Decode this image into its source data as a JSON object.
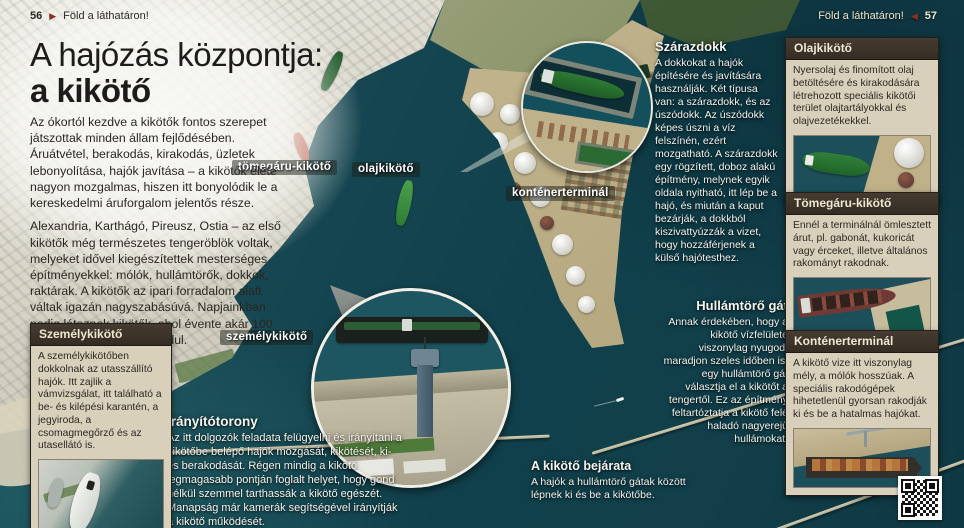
{
  "header_left": {
    "page_number": "56",
    "arrow": "▶",
    "title": "Föld a láthatáron!"
  },
  "header_right": {
    "title": "Föld a láthatáron!",
    "arrow": "◀",
    "page_number": "57"
  },
  "title": {
    "line1": "A hajózás központja:",
    "line2": "a kikötő"
  },
  "intro": {
    "p1": "Az ókortól kezdve a kikötők fontos szerepet játszottak minden állam fejlődésében. Áruátvétel, berakodás, kirakodás, üzletek lebonyolítása, hajók javítása – a kikötők élete nagyon mozgalmas, hiszen itt bonyolódik le a kereskedelmi áruforgalom jelentős része.",
    "p2": "Alexandria, Karthágó, Pireusz, Ostia – az első kikötők még természetes tengeröblök voltak, melyeket idővel kiegészítettek mesterséges építményekkel: mólók, hullámtörők, dokkok, raktárak. A kikötők az ipari forradalom alatt váltak igazán nagyszabásúvá. Napjainkban pedig léteznek kikötők, ahol évente akár 100 millió tonna áru is megfordul."
  },
  "photo_labels": {
    "bulk": "tömegáru-kikötő",
    "oil": "olajkikötő",
    "container": "konténerterminál",
    "passenger": "személykikötő"
  },
  "annotations": {
    "drydock": {
      "title": "Szárazdokk",
      "body": "A dokkokat a hajók építésére és javítására használják. Két típusa van: a szárazdokk, és az úszódokk. Az úszódokk képes úszni a víz felszínén, ezért mozgatható. A szárazdokk egy rögzített, doboz alakú építmény, melynek egyik oldala nyitható, itt lép be a hajó, és miután a kaput bezárják, a dokkból kiszivattyúzzák a vizet, hogy hozzáférjenek a külső hajótesthez."
    },
    "breakwater": {
      "title": "Hullámtörő gát",
      "body": "Annak érdekében, hogy a kikötő vízfelülete viszonylag nyugodt maradjon szeles időben is, egy hullámtörő gát választja el a kikötőt a tengertől. Ez az építmény feltartóztatja a kikötő felé haladó nagyerejű hullámokat."
    },
    "entrance": {
      "title": "A kikötő bejárata",
      "body": "A hajók a hullámtörő gátak között lépnek ki és be a kikötőbe."
    },
    "control_tower": {
      "title": "Irányítótorony",
      "body": "Az itt dolgozók feladata felügyelni és irányítani a kikötőbe belépő hajók mozgását, kikötését, ki- és berakodását. Régen mindig a kikötő legmagasabb pontján foglalt helyet, hogy gond nélkül szemmel tarthassák a kikötő egészét. Manapság már kamerák segítségével irányítják a kikötő működését."
    }
  },
  "info_boxes": {
    "passenger": {
      "title": "Személykikötő",
      "body": "A személykikötőben dokkolnak az utasszállító hajók. Itt zajlik a vámvizsgálat, itt található a be- és kilépési karantén, a jegyiroda, a csomagmegőrző és az utasellátó is."
    },
    "oil": {
      "title": "Olajkikötő",
      "body": "Nyersolaj és finomított olaj betöltésére és kirakodására létrehozott speciális kikötői terület olajtartályokkal és olajvezetékekkel."
    },
    "bulk": {
      "title": "Tömegáru-kikötő",
      "body": "Ennél a terminálnál ömlesztett árut, pl. gabonát, kukoricát vagy érceket, illetve általános rakományt rakodnak."
    },
    "container": {
      "title": "Konténerterminál",
      "body": "A kikötő vize itt viszonylag mély, a mólók hosszúak. A speciális rakodógépek hihetetlenül gyorsan rakodják ki és be a hatalmas hajókat."
    }
  },
  "colors": {
    "accent_maroon": "#8c2f21",
    "box_beige": "#d9d0bc",
    "box_header_brown": "#3a3128",
    "water_teal": "#123e48",
    "annotation_text": "#f4f3ee"
  }
}
